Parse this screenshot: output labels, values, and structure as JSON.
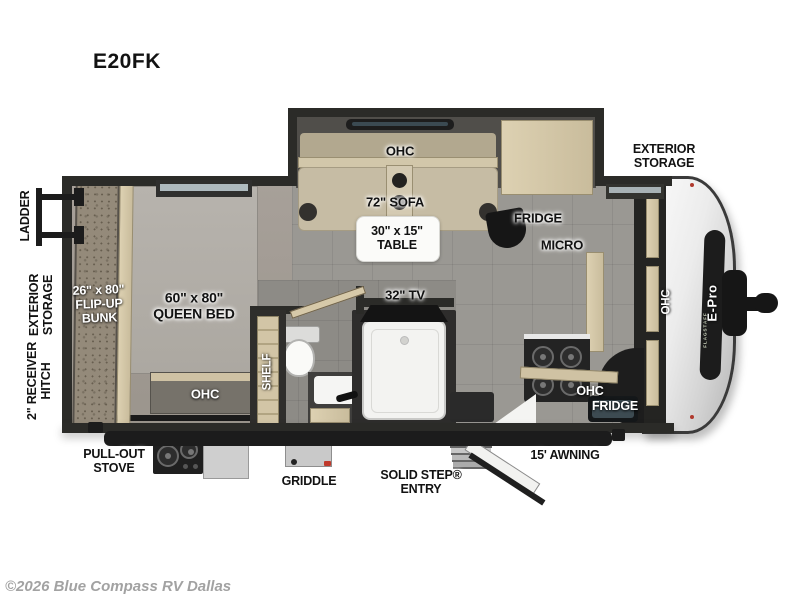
{
  "title": "E20FK",
  "copyright": "©2026 Blue Compass RV Dallas",
  "colors": {
    "brand_green": "#7cb93e",
    "wall": "#2b2b28",
    "floor_main": "#9a9893",
    "sofa_tan": "#c6bca4",
    "cap_silver": "#ececec"
  },
  "exterior_labels": {
    "ladder": "LADDER",
    "exterior_storage_left": "EXTERIOR\nSTORAGE",
    "receiver_hitch": "2\" RECEIVER\nHITCH",
    "exterior_storage_right": "EXTERIOR\nSTORAGE",
    "pull_out_stove": "PULL-OUT\nSTOVE",
    "griddle": "GRIDDLE",
    "solid_step": "SOLID STEP®\nENTRY",
    "awning": "15' AWNING"
  },
  "interior_labels": {
    "bunk": "26\" x 80\"\nFLIP-UP\nBUNK",
    "queen_bed": "60\" x 80\"\nQUEEN BED",
    "bed_ohc": "OHC",
    "shelf": "SHELF",
    "slide_ohc": "OHC",
    "sofa": "72\" SOFA",
    "table": "30\" x 15\"\nTABLE",
    "fridge_upper": "FRIDGE",
    "micro": "MICRO",
    "tv": "32\" TV",
    "kitchen_ohc": "OHC",
    "kitchen_fridge": "FRIDGE",
    "cap_ohc": "OHC"
  },
  "logo": {
    "brand": "E-Pro",
    "sub": "FLAGSTAFF"
  }
}
